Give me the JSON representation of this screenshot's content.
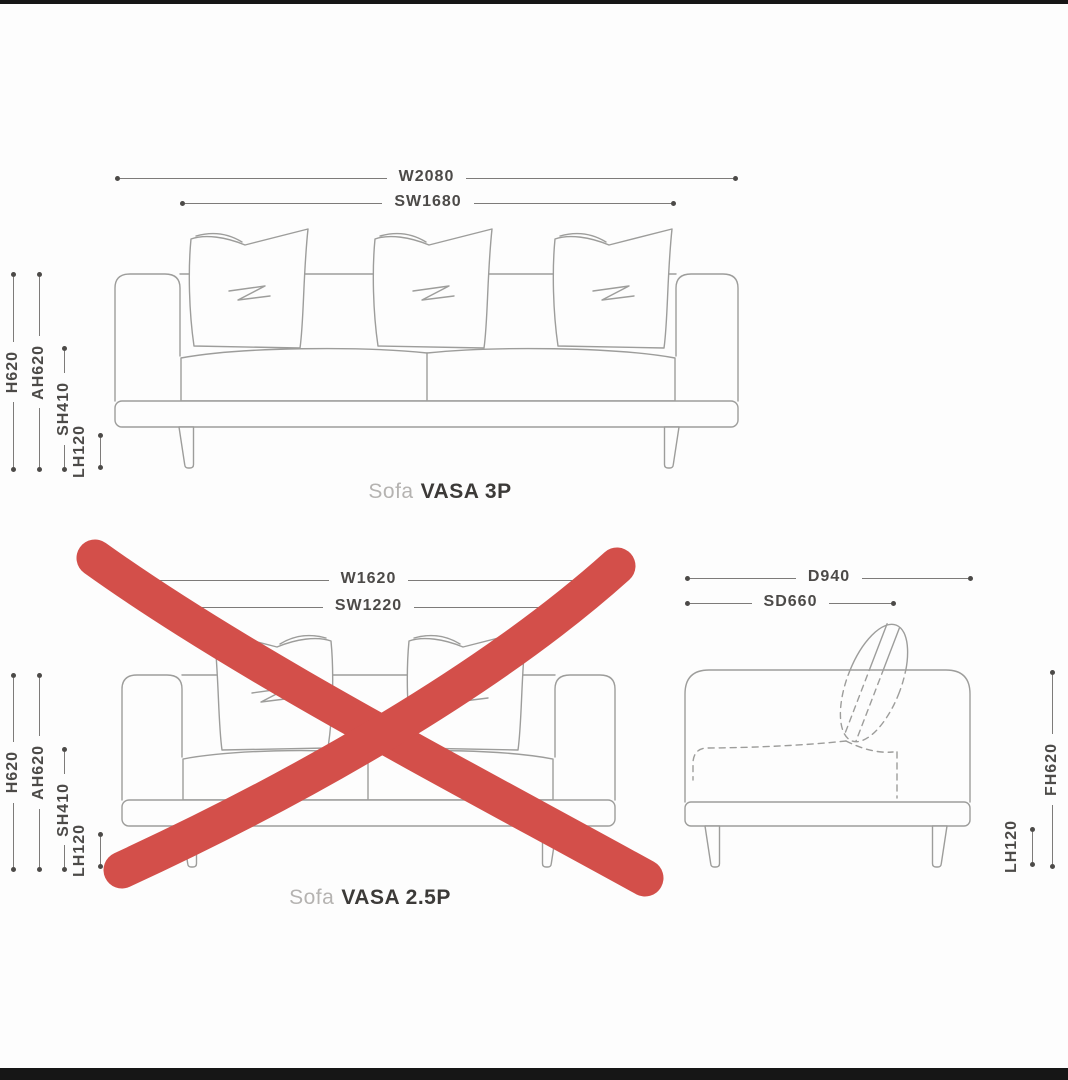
{
  "colors": {
    "background": "#fdfdfd",
    "letterbox": "#161616",
    "sofa_line": "#9d9d9b",
    "dim_line": "#7d7b79",
    "dim_text": "#4c4a48",
    "title_prefix": "#b5b3b1",
    "title_text": "#3c3a38",
    "cross_red": "#d34f4a"
  },
  "sofa_3p": {
    "title_prefix": "Sofa",
    "title_name": "VASA 3P",
    "crossed_out": false,
    "dims": {
      "width": "W2080",
      "seat_width": "SW1680",
      "height": "H620",
      "arm_height": "AH620",
      "seat_height": "SH410",
      "leg_height": "LH120"
    }
  },
  "sofa_25p": {
    "title_prefix": "Sofa",
    "title_name": "VASA 2.5P",
    "crossed_out": true,
    "dims": {
      "width": "W1620",
      "seat_width": "SW1220",
      "height": "H620",
      "arm_height": "AH620",
      "seat_height": "SH410",
      "leg_height": "LH120"
    }
  },
  "side_view": {
    "dims": {
      "depth": "D940",
      "seat_depth": "SD660",
      "frame_height": "FH620",
      "leg_height": "LH120"
    }
  }
}
